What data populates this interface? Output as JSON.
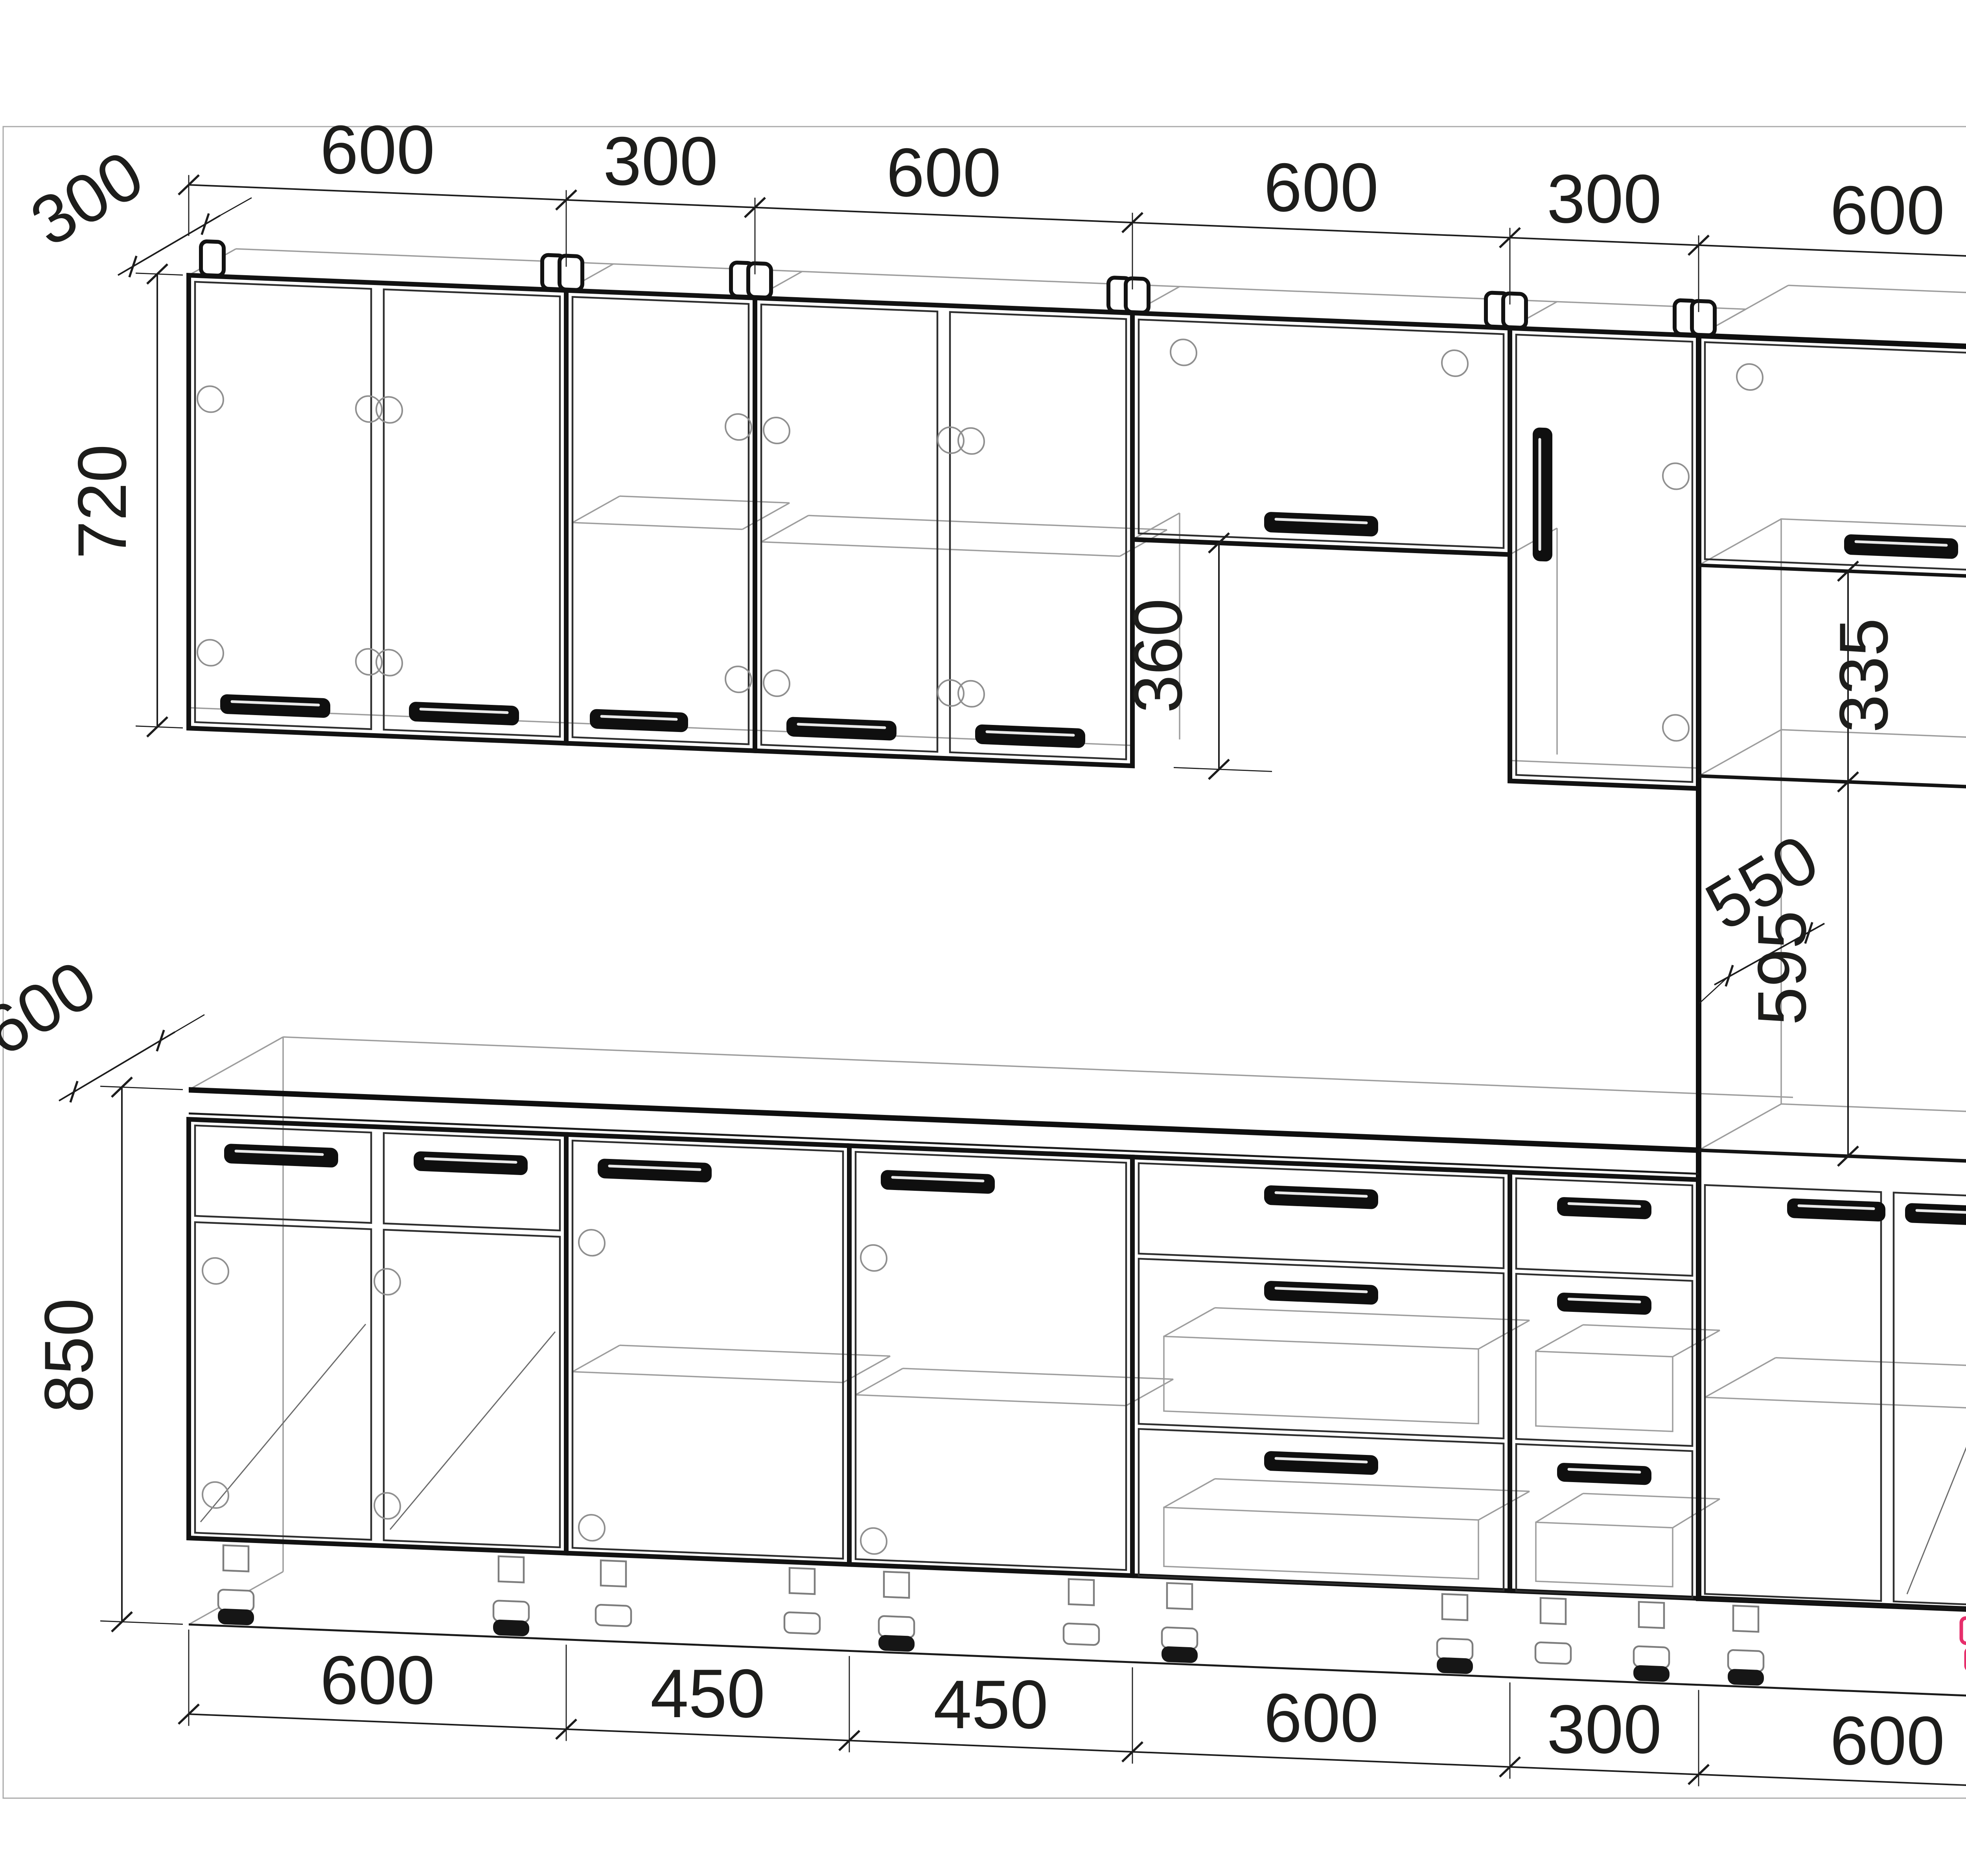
{
  "meta": {
    "description": "Kitchen cabinet set assembly drawing (axonometric wireframe) with dimensions",
    "units": "mm"
  },
  "colors": {
    "line": "#1a1a1a",
    "light": "#9d9d9d",
    "accent": "#e62e6b",
    "text": "#1d1d1b",
    "bg": "#ffffff"
  },
  "dimensions": {
    "top_chain": [
      "600",
      "300",
      "600",
      "600",
      "300",
      "600"
    ],
    "bottom_chain": [
      "600",
      "450",
      "450",
      "600",
      "300",
      "600"
    ],
    "wall_cabinet_depth": "300",
    "wall_cabinet_height": "720",
    "hood_opening_height": "360",
    "tall_unit_depth": "570",
    "tall_niche_height": "335",
    "tall_niche_inner_depth": "550",
    "oven_niche_height": "595",
    "tall_unit_total_height": "2145",
    "base_depth": "600",
    "base_height": "850"
  },
  "modules": {
    "wall_row": [
      {
        "width": "600",
        "fronts": "2 doors"
      },
      {
        "width": "300",
        "fronts": "1 door"
      },
      {
        "width": "600",
        "fronts": "2 doors"
      },
      {
        "width": "600",
        "fronts": "flip-up door over 360 opening"
      },
      {
        "width": "300",
        "fronts": "1 door, vertical handle"
      },
      {
        "width": "600",
        "fronts": "tall unit top flip-up door"
      }
    ],
    "base_row": [
      {
        "width": "600",
        "fronts": "2 drawer fronts + 2 doors"
      },
      {
        "width": "450",
        "fronts": "1 door + shelf"
      },
      {
        "width": "450",
        "fronts": "1 door + shelf"
      },
      {
        "width": "600",
        "fronts": "3 drawers"
      },
      {
        "width": "300",
        "fronts": "3 drawers"
      },
      {
        "width": "600",
        "fronts": "tall unit base, 2 doors + shelf, highlighted leg"
      }
    ]
  }
}
